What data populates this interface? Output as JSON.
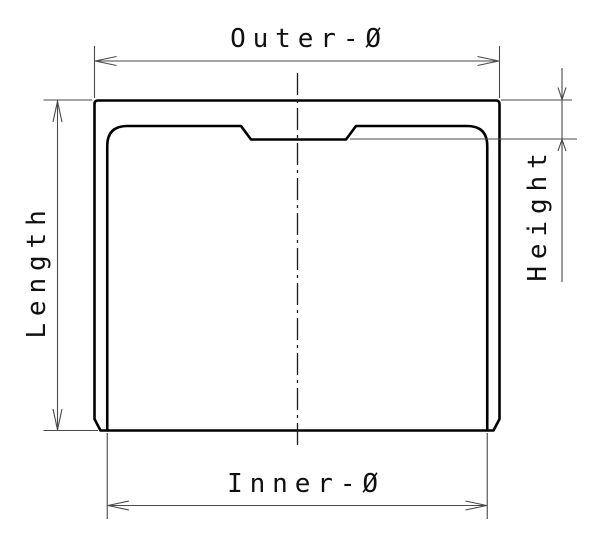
{
  "drawing": {
    "labels": {
      "outer_diameter": "Outer-Ø",
      "inner_diameter": "Inner-Ø",
      "length": "Length",
      "height": "Height"
    },
    "colors": {
      "background": "#ffffff",
      "part_outline": "#000000",
      "hatch_line": "#2b2b2b",
      "dimension_line": "#4a4a4a",
      "text": "#101010"
    }
  }
}
